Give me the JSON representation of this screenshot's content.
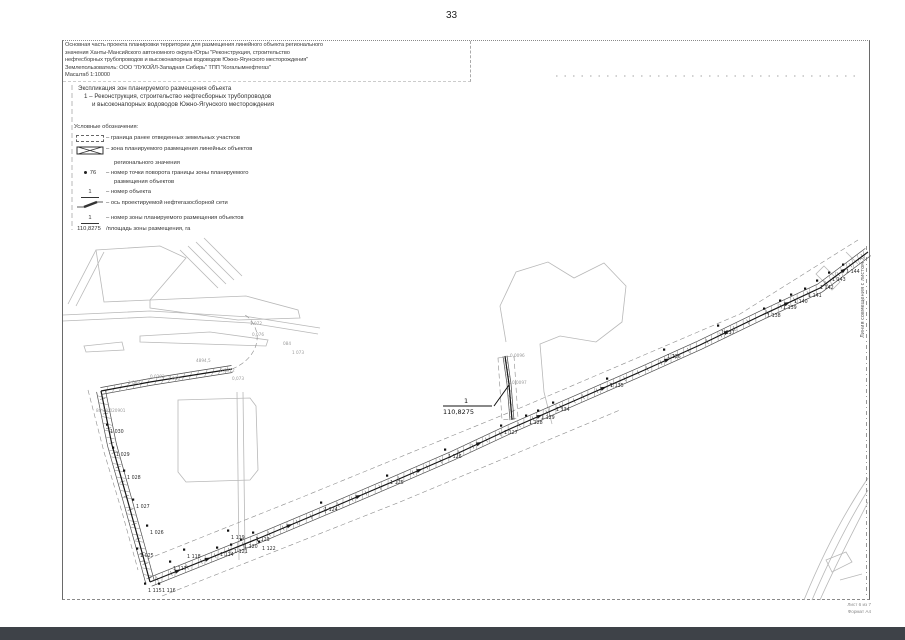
{
  "page": {
    "number": "33",
    "footer_note_line1": "Лист 6 из 7",
    "footer_note_line2": "Формат А4"
  },
  "title_block": {
    "lines": [
      "Основная часть проекта планировки территории для размещения линейного объекта регионального",
      "значения Ханты-Мансийского автономного округа-Югры \"Реконструкция, строительство",
      "нефтесборных трубопроводов и высоконапорных водоводов Южно-Ягунского месторождения\"",
      "Землепользователь: ООО \"ЛУКОЙЛ-Западная Сибирь\" ТПП \"Когалымнефтегаз\"",
      "Масштаб 1:10000"
    ]
  },
  "explication": {
    "title": "Экспликация зон планируемого размещения объекта",
    "line1": "1 – Реконструкция, строительство нефтесборных трубопроводов",
    "line2": "и высоконапорных водоводов Южно-Ягунского месторождения"
  },
  "legend": {
    "title": "Условные обозначения:",
    "items": [
      {
        "label": "– граница ранее отведенных земельных участков"
      },
      {
        "label": "– зона планируемого размещения линейных объектов",
        "label2": "регионального значения"
      },
      {
        "symbol_text": "76",
        "label": "– номер точки поворота границы зоны планируемого",
        "label2": "размещения объектов"
      },
      {
        "symbol_text": "1",
        "label": "– номер объекта"
      },
      {
        "label": "– ось проектируемой нефтегазосборной сети"
      },
      {
        "symbol_text": "1",
        "label": "– номер зоны планируемого размещения объектов"
      },
      {
        "symbol_text": "110,8275",
        "label": "/площадь зоны размещения, га"
      }
    ]
  },
  "map": {
    "match_line_text": "Линия совмещения с листом 7",
    "zone_label": {
      "number": "1",
      "area": "110,8275"
    },
    "leader": {
      "from": [
        494,
        406
      ],
      "to": [
        509,
        385
      ]
    },
    "corridors": [
      {
        "name": "main",
        "width": 9,
        "ticks": true,
        "arrows": true,
        "axis": [
          [
            150,
            582
          ],
          [
            180,
            570
          ],
          [
            262,
            537
          ],
          [
            331,
            508
          ],
          [
            392,
            482
          ],
          [
            452,
            456
          ],
          [
            512,
            428
          ],
          [
            576,
            400
          ],
          [
            640,
            372
          ],
          [
            700,
            345
          ],
          [
            760,
            316
          ],
          [
            820,
            288
          ],
          [
            868,
            252
          ]
        ]
      },
      {
        "name": "left",
        "width": 9,
        "ticks": true,
        "axis": [
          [
            101,
            391
          ],
          [
            112,
            445
          ],
          [
            128,
            502
          ],
          [
            143,
            556
          ],
          [
            150,
            582
          ]
        ]
      },
      {
        "name": "upper-left",
        "width": 7,
        "axis": [
          [
            101,
            391
          ],
          [
            150,
            382
          ],
          [
            200,
            374
          ],
          [
            232,
            369
          ]
        ]
      },
      {
        "name": "spur",
        "width": 4,
        "axis": [
          [
            505,
            356
          ],
          [
            509,
            384
          ],
          [
            512,
            420
          ]
        ]
      }
    ],
    "points": [
      {
        "label": "1 030",
        "x": 110,
        "y": 433
      },
      {
        "label": "1 029",
        "x": 116,
        "y": 456
      },
      {
        "label": "1 028",
        "x": 127,
        "y": 479
      },
      {
        "label": "1 027",
        "x": 136,
        "y": 508
      },
      {
        "label": "1 026",
        "x": 150,
        "y": 534
      },
      {
        "label": "1 025",
        "x": 140,
        "y": 557
      },
      {
        "label": "1 115",
        "x": 148,
        "y": 592
      },
      {
        "label": "1 116",
        "x": 162,
        "y": 592
      },
      {
        "label": "1 117",
        "x": 173,
        "y": 570
      },
      {
        "label": "1 118",
        "x": 187,
        "y": 558
      },
      {
        "label": "1 114",
        "x": 220,
        "y": 556
      },
      {
        "label": "1 119",
        "x": 231,
        "y": 539
      },
      {
        "label": "1 120",
        "x": 244,
        "y": 548
      },
      {
        "label": "1 121",
        "x": 234,
        "y": 553
      },
      {
        "label": "1 122",
        "x": 262,
        "y": 550
      },
      {
        "label": "1 123",
        "x": 256,
        "y": 541
      },
      {
        "label": "1 124",
        "x": 324,
        "y": 511
      },
      {
        "label": "1 125",
        "x": 390,
        "y": 484
      },
      {
        "label": "1 126",
        "x": 448,
        "y": 458
      },
      {
        "label": "1 127",
        "x": 504,
        "y": 434
      },
      {
        "label": "1 128",
        "x": 529,
        "y": 424
      },
      {
        "label": "1 129",
        "x": 541,
        "y": 419
      },
      {
        "label": "1 134",
        "x": 556,
        "y": 411
      },
      {
        "label": "1 135",
        "x": 610,
        "y": 387
      },
      {
        "label": "1 136",
        "x": 667,
        "y": 358
      },
      {
        "label": "1 137",
        "x": 721,
        "y": 334
      },
      {
        "label": "1 138",
        "x": 767,
        "y": 317
      },
      {
        "label": "1 139",
        "x": 783,
        "y": 309
      },
      {
        "label": "1 140",
        "x": 794,
        "y": 303
      },
      {
        "label": "1 141",
        "x": 808,
        "y": 297
      },
      {
        "label": "1 142",
        "x": 820,
        "y": 289
      },
      {
        "label": "1 143",
        "x": 832,
        "y": 281
      },
      {
        "label": "1 144",
        "x": 846,
        "y": 273
      }
    ],
    "small_labels": [
      {
        "t": "86:10:020901",
        "x": 96,
        "y": 412
      },
      {
        "t": "4894,5",
        "x": 196,
        "y": 362
      },
      {
        "t": "0,0912",
        "x": 220,
        "y": 372
      },
      {
        "t": "0,0292",
        "x": 150,
        "y": 378
      },
      {
        "t": "1 068",
        "x": 128,
        "y": 384
      },
      {
        "t": "1 066",
        "x": 168,
        "y": 380
      },
      {
        "t": "0,073",
        "x": 232,
        "y": 380
      },
      {
        "t": "1 072",
        "x": 250,
        "y": 325
      },
      {
        "t": "0,076",
        "x": 252,
        "y": 336
      },
      {
        "t": "084",
        "x": 283,
        "y": 345
      },
      {
        "t": "1 073",
        "x": 292,
        "y": 354
      },
      {
        "t": "0,0096",
        "x": 510,
        "y": 357
      },
      {
        "t": "0,0097",
        "x": 512,
        "y": 384
      }
    ]
  }
}
